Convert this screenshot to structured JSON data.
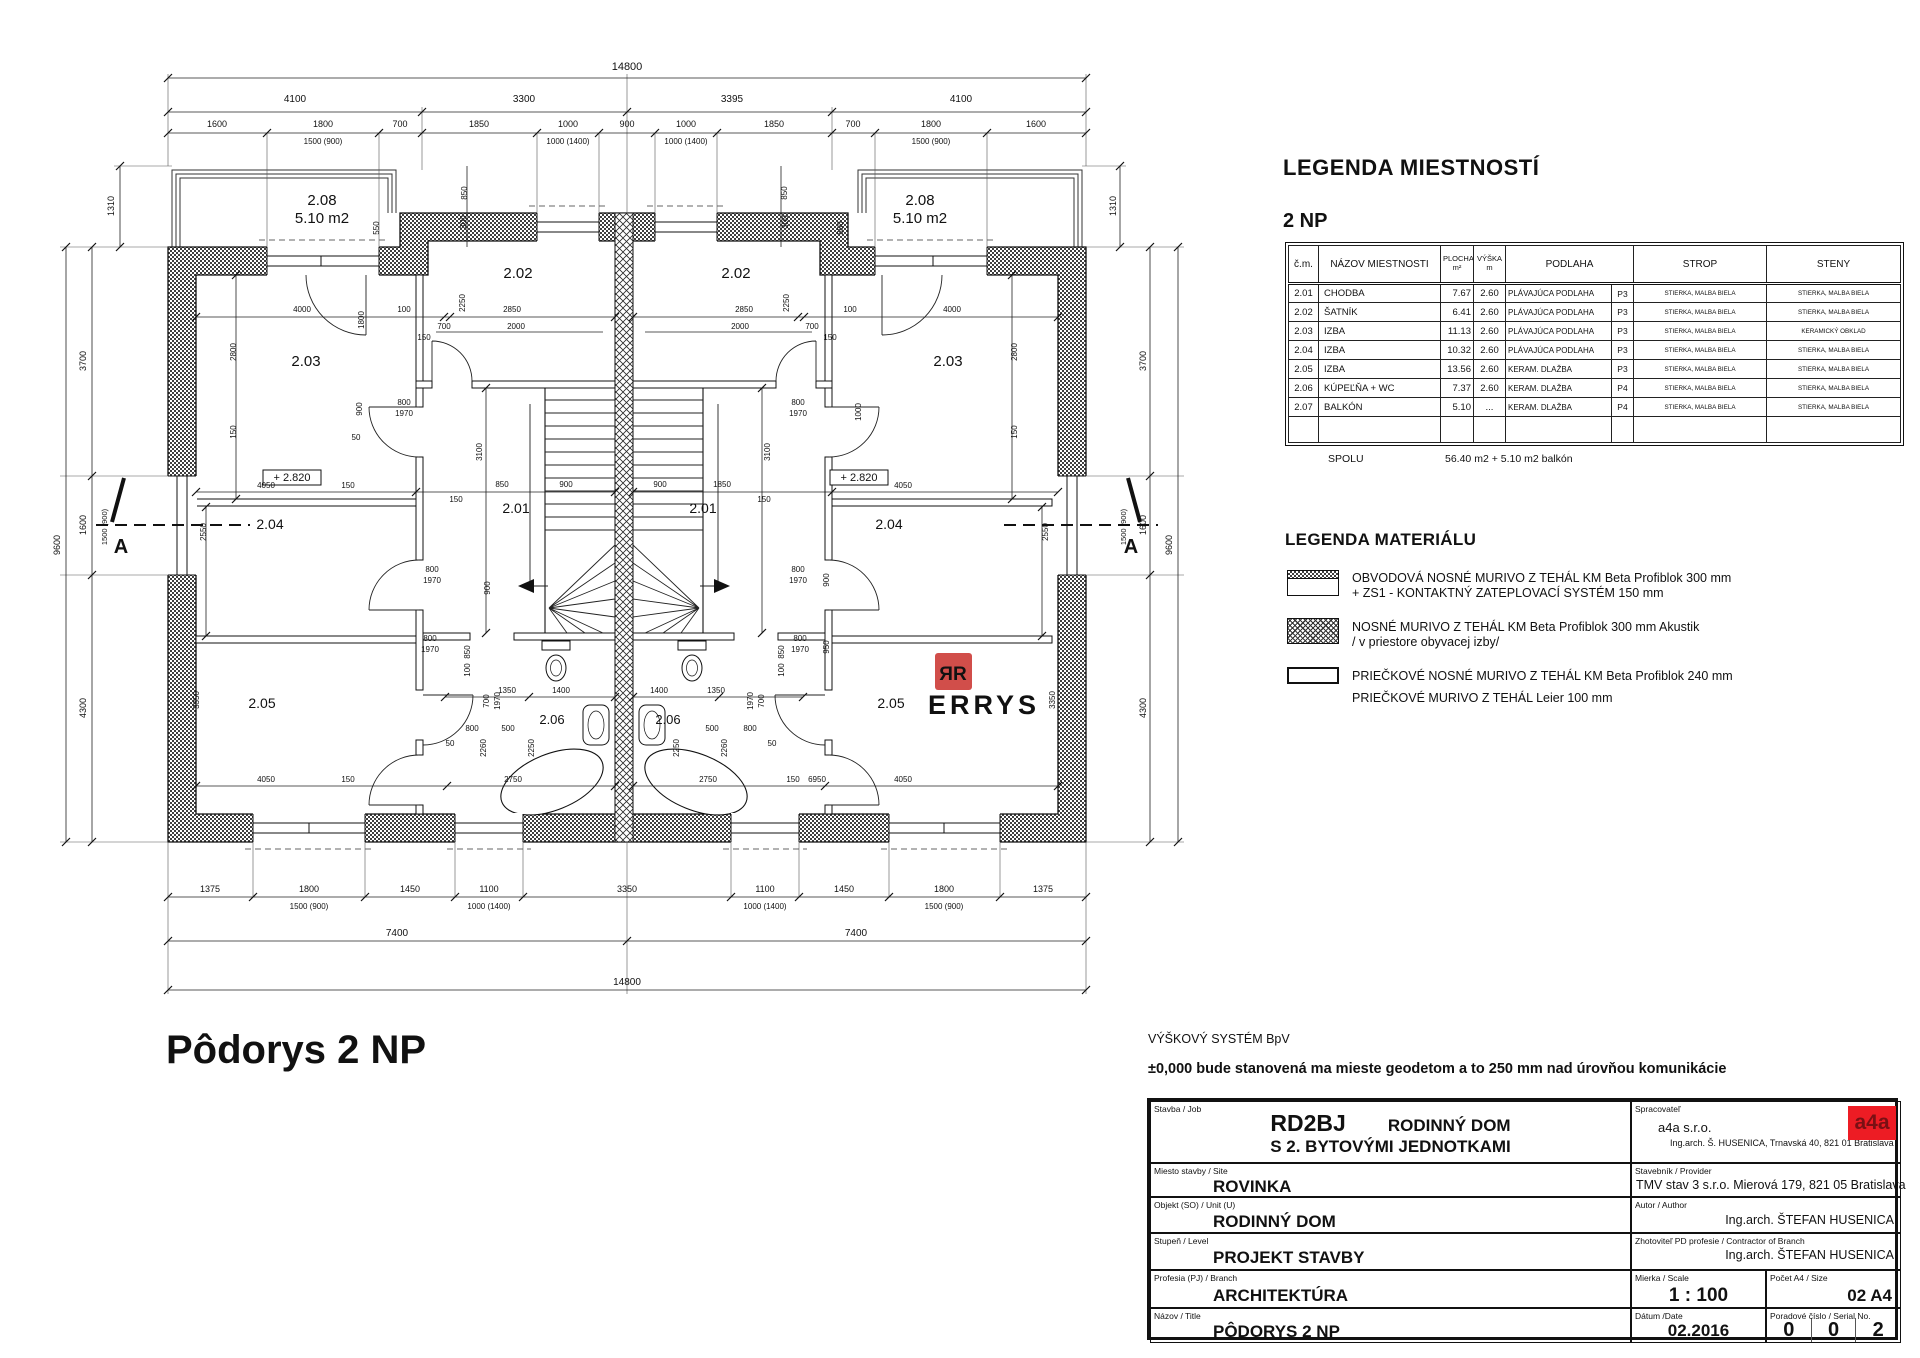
{
  "legend_rooms": {
    "title": "LEGENDA MIESTNOSTÍ",
    "subtitle": "2 NP",
    "header": {
      "cm": "č.m.",
      "nazov": "NÁZOV MIESTNOSTI",
      "plocha1": "PLOCHA",
      "plocha2": "m²",
      "vyska1": "VÝŠKA",
      "vyska2": "m",
      "podlaha": "PODLAHA",
      "strop": "STROP",
      "steny": "STENY"
    },
    "rows": [
      [
        "2.01",
        "CHODBA",
        "7.67",
        "2.60",
        "PLÁVAJÚCA PODLAHA",
        "P3",
        "STIERKA, MALBA BIELA",
        "STIERKA, MALBA BIELA"
      ],
      [
        "2.02",
        "ŠATNÍK",
        "6.41",
        "2.60",
        "PLÁVAJÚCA PODLAHA",
        "P3",
        "STIERKA, MALBA BIELA",
        "STIERKA, MALBA BIELA"
      ],
      [
        "2.03",
        "IZBA",
        "11.13",
        "2.60",
        "PLÁVAJÚCA PODLAHA",
        "P3",
        "STIERKA, MALBA BIELA",
        "KERAMICKÝ OBKLAD"
      ],
      [
        "2.04",
        "IZBA",
        "10.32",
        "2.60",
        "PLÁVAJÚCA PODLAHA",
        "P3",
        "STIERKA, MALBA BIELA",
        "STIERKA, MALBA BIELA"
      ],
      [
        "2.05",
        "IZBA",
        "13.56",
        "2.60",
        "KERAM. DLAŽBA",
        "P3",
        "STIERKA, MALBA BIELA",
        "STIERKA, MALBA BIELA"
      ],
      [
        "2.06",
        "KÚPEĽŇA + WC",
        "7.37",
        "2.60",
        "KERAM. DLAŽBA",
        "P4",
        "STIERKA, MALBA BIELA",
        "STIERKA, MALBA BIELA"
      ],
      [
        "2.07",
        "BALKÓN",
        "5.10",
        "...",
        "KERAM. DLAŽBA",
        "P4",
        "STIERKA, MALBA BIELA",
        "STIERKA, MALBA BIELA"
      ],
      [
        "",
        "",
        "",
        "",
        "",
        "",
        "",
        ""
      ]
    ],
    "spolu_label": "SPOLU",
    "spolu_value": "56.40 m2 + 5.10 m2 balkón"
  },
  "legend_material": {
    "title": "LEGENDA MATERIÁLU",
    "items": [
      {
        "line1": "OBVODOVÁ NOSNÉ MURIVO Z TEHÁL KM Beta Profiblok 300 mm",
        "line2": "+ ZS1 - KONTAKTNÝ ZATEPLOVACÍ SYSTÉM  150 mm"
      },
      {
        "line1": "NOSNÉ MURIVO Z TEHÁL KM Beta Profiblok 300 mm Akustik",
        "line2": "/ v priestore obyvacej izby/"
      },
      {
        "line1": "PRIEČKOVÉ NOSNÉ MURIVO Z TEHÁL KM Beta Profiblok 240 mm",
        "line2": "PRIEČKOVÉ MURIVO Z TEHÁL Leier 100 mm"
      }
    ]
  },
  "notes": {
    "line1": "VÝŠKOVÝ SYSTÉM BpV",
    "line2": "±0,000  bude stanovená ma mieste geodetom a to 250 mm nad úrovňou komunikácie"
  },
  "plan_title": "Pôdorys 2 NP",
  "colors": {
    "logo_red": "#ed1c24",
    "logo_text": "#7a1014",
    "watermark_red": "#cc3b36",
    "watermark_gray": "#c9c9c9"
  },
  "title_block": {
    "stavba_label": "Stavba / Job",
    "stavba_code": "RD2BJ",
    "stavba_value1": "RODINNÝ DOM",
    "stavba_value2": "S 2. BYTOVÝMI JEDNOTKAMI",
    "miesto_label": "Miesto stavby / Site",
    "miesto_value": "ROVINKA",
    "objekt_label": "Objekt (SO) / Unit (U)",
    "objekt_value": "RODINNÝ DOM",
    "stupen_label": "Stupeň / Level",
    "stupen_value": "PROJEKT STAVBY",
    "profesia_label": "Profesia (PJ) / Branch",
    "profesia_value": "ARCHITEKTÚRA",
    "nazov_label": "Názov / Title",
    "nazov_value": "PÔDORYS 2 NP",
    "spracovatel_label": "Spracovateľ",
    "spracovatel_value1": "a4a s.r.o.",
    "spracovatel_value2": "Ing.arch. Š. HUSENICA, Trnavská 40, 821 01 Bratislava",
    "logo": "a4a",
    "stavebnik_label": "Stavebník / Provider",
    "stavebnik_value": "TMV stav 3 s.r.o. Mierová 179, 821 05 Bratislava",
    "autor_label": "Autor / Author",
    "autor_value": "Ing.arch. ŠTEFAN HUSENICA",
    "zhotovitel_label": "Zhotoviteľ PD profesie / Contractor of Branch",
    "zhotovitel_value": "Ing.arch. ŠTEFAN HUSENICA",
    "mierka_label": "Mierka / Scale",
    "mierka_value": "1 : 100",
    "pocet_label": "Počet A4 / Size",
    "pocet_value": "02 A4",
    "datum_label": "Dátum /Date",
    "datum_value": "02.2016",
    "poradove_label": "Poradové číslo / Serial No.",
    "serial": [
      "0",
      "0",
      "2"
    ]
  },
  "plan": {
    "labels": [
      {
        "t": "14800",
        "x": 627,
        "y": 70,
        "s": 11
      },
      {
        "t": "4100",
        "x": 295,
        "y": 102,
        "s": 10
      },
      {
        "t": "3300",
        "x": 524,
        "y": 102,
        "s": 10
      },
      {
        "t": "3395",
        "x": 732,
        "y": 102,
        "s": 10
      },
      {
        "t": "4100",
        "x": 961,
        "y": 102,
        "s": 10
      },
      {
        "t": "1600",
        "x": 217,
        "y": 127,
        "s": 9
      },
      {
        "t": "1800",
        "x": 323,
        "y": 127,
        "s": 9
      },
      {
        "t": "700",
        "x": 400,
        "y": 127,
        "s": 9
      },
      {
        "t": "1850",
        "x": 479,
        "y": 127,
        "s": 9
      },
      {
        "t": "1000",
        "x": 568,
        "y": 127,
        "s": 9
      },
      {
        "t": "900",
        "x": 627,
        "y": 127,
        "s": 9
      },
      {
        "t": "1000",
        "x": 686,
        "y": 127,
        "s": 9
      },
      {
        "t": "1850",
        "x": 774,
        "y": 127,
        "s": 9
      },
      {
        "t": "700",
        "x": 853,
        "y": 127,
        "s": 9
      },
      {
        "t": "1800",
        "x": 931,
        "y": 127,
        "s": 9
      },
      {
        "t": "1600",
        "x": 1036,
        "y": 127,
        "s": 9
      },
      {
        "t": "1500 (900)",
        "x": 323,
        "y": 144,
        "s": 8
      },
      {
        "t": "1000 (1400)",
        "x": 568,
        "y": 144,
        "s": 8
      },
      {
        "t": "1000 (1400)",
        "x": 686,
        "y": 144,
        "s": 8
      },
      {
        "t": "1500 (900)",
        "x": 931,
        "y": 144,
        "s": 8
      },
      {
        "t": "1375",
        "x": 210,
        "y": 892,
        "s": 9
      },
      {
        "t": "1800",
        "x": 309,
        "y": 892,
        "s": 9
      },
      {
        "t": "1450",
        "x": 410,
        "y": 892,
        "s": 9
      },
      {
        "t": "1100",
        "x": 489,
        "y": 892,
        "s": 9
      },
      {
        "t": "3350",
        "x": 627,
        "y": 892,
        "s": 9
      },
      {
        "t": "1100",
        "x": 765,
        "y": 892,
        "s": 9
      },
      {
        "t": "1450",
        "x": 844,
        "y": 892,
        "s": 9
      },
      {
        "t": "1800",
        "x": 944,
        "y": 892,
        "s": 9
      },
      {
        "t": "1375",
        "x": 1043,
        "y": 892,
        "s": 9
      },
      {
        "t": "1500 (900)",
        "x": 309,
        "y": 909,
        "s": 8
      },
      {
        "t": "1000 (1400)",
        "x": 489,
        "y": 909,
        "s": 8
      },
      {
        "t": "1000 (1400)",
        "x": 765,
        "y": 909,
        "s": 8
      },
      {
        "t": "1500 (900)",
        "x": 944,
        "y": 909,
        "s": 8
      },
      {
        "t": "7400",
        "x": 397,
        "y": 936,
        "s": 10
      },
      {
        "t": "7400",
        "x": 856,
        "y": 936,
        "s": 10
      },
      {
        "t": "14800",
        "x": 627,
        "y": 985,
        "s": 10
      },
      {
        "t": "9600",
        "x": 60,
        "y": 545,
        "r": -90
      },
      {
        "t": "3700",
        "x": 86,
        "y": 361,
        "r": -90
      },
      {
        "t": "1600",
        "x": 86,
        "y": 525,
        "r": -90
      },
      {
        "t": "4300",
        "x": 86,
        "y": 708,
        "r": -90
      },
      {
        "t": "1500 (900)",
        "x": 107,
        "y": 527,
        "r": -90,
        "s": 7.5
      },
      {
        "t": "1310",
        "x": 114,
        "y": 206,
        "r": -90
      },
      {
        "t": "1310",
        "x": 1116,
        "y": 206,
        "r": -90
      },
      {
        "t": "3700",
        "x": 1146,
        "y": 361,
        "r": -90
      },
      {
        "t": "1600",
        "x": 1146,
        "y": 525,
        "r": -90
      },
      {
        "t": "4300",
        "x": 1146,
        "y": 708,
        "r": -90
      },
      {
        "t": "1500 (900)",
        "x": 1126,
        "y": 527,
        "r": -90,
        "s": 7.5
      },
      {
        "t": "9600",
        "x": 1172,
        "y": 545,
        "r": -90
      },
      {
        "t": "2.08",
        "x": 322,
        "y": 205,
        "s": 15
      },
      {
        "t": "5.10 m2",
        "x": 322,
        "y": 223,
        "s": 15
      },
      {
        "t": "2.08",
        "x": 920,
        "y": 205,
        "s": 15
      },
      {
        "t": "5.10 m2",
        "x": 920,
        "y": 223,
        "s": 15
      },
      {
        "t": "2.02",
        "x": 518,
        "y": 278,
        "s": 15
      },
      {
        "t": "2.02",
        "x": 736,
        "y": 278,
        "s": 15
      },
      {
        "t": "2.03",
        "x": 306,
        "y": 366,
        "s": 15
      },
      {
        "t": "2.03",
        "x": 948,
        "y": 366,
        "s": 15
      },
      {
        "t": "2.01",
        "x": 516,
        "y": 513,
        "s": 14
      },
      {
        "t": "2.01",
        "x": 703,
        "y": 513,
        "s": 14
      },
      {
        "t": "2.04",
        "x": 270,
        "y": 529,
        "s": 14
      },
      {
        "t": "2.04",
        "x": 889,
        "y": 529,
        "s": 14
      },
      {
        "t": "2.05",
        "x": 262,
        "y": 708,
        "s": 14
      },
      {
        "t": "2.05",
        "x": 891,
        "y": 708,
        "s": 14
      },
      {
        "t": "2.06",
        "x": 552,
        "y": 724,
        "s": 13
      },
      {
        "t": "2.06",
        "x": 668,
        "y": 724,
        "s": 13
      },
      {
        "t": "+ 2.820",
        "x": 292,
        "y": 481,
        "s": 11
      },
      {
        "t": "+ 2.820",
        "x": 859,
        "y": 481,
        "s": 11
      },
      {
        "t": "A",
        "x": 121,
        "y": 553,
        "s": 20,
        "w": 700
      },
      {
        "t": "A",
        "x": 1131,
        "y": 553,
        "s": 20,
        "w": 700
      },
      {
        "t": "4000",
        "x": 302,
        "y": 312,
        "s": 8
      },
      {
        "t": "100",
        "x": 404,
        "y": 312,
        "s": 8
      },
      {
        "t": "2850",
        "x": 512,
        "y": 312,
        "s": 8
      },
      {
        "t": "150",
        "x": 424,
        "y": 340,
        "s": 8
      },
      {
        "t": "700",
        "x": 444,
        "y": 329,
        "s": 8
      },
      {
        "t": "2000",
        "x": 516,
        "y": 329,
        "s": 8
      },
      {
        "t": "2800",
        "x": 236,
        "y": 352,
        "r": -90,
        "s": 8
      },
      {
        "t": "150",
        "x": 236,
        "y": 432,
        "r": -90,
        "s": 8
      },
      {
        "t": "1800",
        "x": 364,
        "y": 320,
        "r": -90,
        "s": 8
      },
      {
        "t": "2250",
        "x": 465,
        "y": 303,
        "r": -90,
        "s": 8
      },
      {
        "t": "850",
        "x": 467,
        "y": 193,
        "r": -90,
        "s": 8
      },
      {
        "t": "300",
        "x": 466,
        "y": 222,
        "r": -90,
        "s": 8
      },
      {
        "t": "550",
        "x": 379,
        "y": 228,
        "r": -90,
        "s": 8
      },
      {
        "t": "900",
        "x": 362,
        "y": 409,
        "r": -90,
        "s": 8
      },
      {
        "t": "50",
        "x": 356,
        "y": 440,
        "s": 8
      },
      {
        "t": "800",
        "x": 404,
        "y": 405,
        "s": 8
      },
      {
        "t": "1970",
        "x": 404,
        "y": 416,
        "s": 8
      },
      {
        "t": "2550",
        "x": 206,
        "y": 532,
        "r": -90,
        "s": 8
      },
      {
        "t": "4050",
        "x": 266,
        "y": 488,
        "s": 8
      },
      {
        "t": "150",
        "x": 348,
        "y": 488,
        "s": 8
      },
      {
        "t": "3100",
        "x": 482,
        "y": 452,
        "r": -90,
        "s": 8
      },
      {
        "t": "850",
        "x": 502,
        "y": 487,
        "s": 8
      },
      {
        "t": "900",
        "x": 566,
        "y": 487,
        "s": 8
      },
      {
        "t": "150",
        "x": 456,
        "y": 502,
        "s": 8
      },
      {
        "t": "900",
        "x": 490,
        "y": 588,
        "r": -90,
        "s": 8
      },
      {
        "t": "850",
        "x": 470,
        "y": 652,
        "r": -90,
        "s": 8
      },
      {
        "t": "100",
        "x": 470,
        "y": 670,
        "r": -90,
        "s": 8
      },
      {
        "t": "800",
        "x": 432,
        "y": 572,
        "s": 8
      },
      {
        "t": "1970",
        "x": 432,
        "y": 583,
        "s": 8
      },
      {
        "t": "800",
        "x": 430,
        "y": 641,
        "s": 8
      },
      {
        "t": "1970",
        "x": 430,
        "y": 652,
        "s": 8
      },
      {
        "t": "700",
        "x": 489,
        "y": 701,
        "r": -90,
        "s": 8
      },
      {
        "t": "1970",
        "x": 500,
        "y": 701,
        "r": -90,
        "s": 8
      },
      {
        "t": "1350",
        "x": 507,
        "y": 693,
        "s": 8
      },
      {
        "t": "1400",
        "x": 561,
        "y": 693,
        "s": 8
      },
      {
        "t": "800",
        "x": 472,
        "y": 731,
        "s": 8
      },
      {
        "t": "500",
        "x": 508,
        "y": 731,
        "s": 8
      },
      {
        "t": "50",
        "x": 450,
        "y": 746,
        "s": 8
      },
      {
        "t": "2260",
        "x": 486,
        "y": 748,
        "r": -90,
        "s": 8
      },
      {
        "t": "2250",
        "x": 534,
        "y": 748,
        "r": -90,
        "s": 8
      },
      {
        "t": "2750",
        "x": 513,
        "y": 782,
        "s": 8
      },
      {
        "t": "3350",
        "x": 199,
        "y": 700,
        "r": -90,
        "s": 8
      },
      {
        "t": "150",
        "x": 348,
        "y": 782,
        "s": 8
      },
      {
        "t": "4050",
        "x": 266,
        "y": 782,
        "s": 8
      },
      {
        "t": "4000",
        "x": 952,
        "y": 312,
        "s": 8
      },
      {
        "t": "100",
        "x": 850,
        "y": 312,
        "s": 8
      },
      {
        "t": "2850",
        "x": 744,
        "y": 312,
        "s": 8
      },
      {
        "t": "150",
        "x": 830,
        "y": 340,
        "s": 8
      },
      {
        "t": "700",
        "x": 812,
        "y": 329,
        "s": 8
      },
      {
        "t": "2000",
        "x": 740,
        "y": 329,
        "s": 8
      },
      {
        "t": "2800",
        "x": 1017,
        "y": 352,
        "r": -90,
        "s": 8
      },
      {
        "t": "150",
        "x": 1017,
        "y": 432,
        "r": -90,
        "s": 8
      },
      {
        "t": "2250",
        "x": 789,
        "y": 303,
        "r": -90,
        "s": 8
      },
      {
        "t": "850",
        "x": 787,
        "y": 193,
        "r": -90,
        "s": 8
      },
      {
        "t": "300",
        "x": 788,
        "y": 222,
        "r": -90,
        "s": 8
      },
      {
        "t": "550",
        "x": 843,
        "y": 228,
        "r": -90,
        "s": 8
      },
      {
        "t": "1000",
        "x": 861,
        "y": 412,
        "r": -90,
        "s": 8
      },
      {
        "t": "800",
        "x": 798,
        "y": 405,
        "s": 8
      },
      {
        "t": "1970",
        "x": 798,
        "y": 416,
        "s": 8
      },
      {
        "t": "2550",
        "x": 1048,
        "y": 532,
        "r": -90,
        "s": 8
      },
      {
        "t": "4050",
        "x": 903,
        "y": 488,
        "s": 8
      },
      {
        "t": "3100",
        "x": 770,
        "y": 452,
        "r": -90,
        "s": 8
      },
      {
        "t": "900",
        "x": 660,
        "y": 487,
        "s": 8
      },
      {
        "t": "1850",
        "x": 722,
        "y": 487,
        "s": 8
      },
      {
        "t": "150",
        "x": 764,
        "y": 502,
        "s": 8
      },
      {
        "t": "900",
        "x": 829,
        "y": 580,
        "r": -90,
        "s": 8
      },
      {
        "t": "950",
        "x": 829,
        "y": 647,
        "r": -90,
        "s": 8
      },
      {
        "t": "850",
        "x": 784,
        "y": 652,
        "r": -90,
        "s": 8
      },
      {
        "t": "100",
        "x": 784,
        "y": 670,
        "r": -90,
        "s": 8
      },
      {
        "t": "800",
        "x": 798,
        "y": 572,
        "s": 8
      },
      {
        "t": "1970",
        "x": 798,
        "y": 583,
        "s": 8
      },
      {
        "t": "800",
        "x": 800,
        "y": 641,
        "s": 8
      },
      {
        "t": "1970",
        "x": 800,
        "y": 652,
        "s": 8
      },
      {
        "t": "1970",
        "x": 753,
        "y": 701,
        "r": -90,
        "s": 8
      },
      {
        "t": "700",
        "x": 764,
        "y": 701,
        "r": -90,
        "s": 8
      },
      {
        "t": "1350",
        "x": 716,
        "y": 693,
        "s": 8
      },
      {
        "t": "1400",
        "x": 659,
        "y": 693,
        "s": 8
      },
      {
        "t": "800",
        "x": 750,
        "y": 731,
        "s": 8
      },
      {
        "t": "500",
        "x": 712,
        "y": 731,
        "s": 8
      },
      {
        "t": "50",
        "x": 772,
        "y": 746,
        "s": 8
      },
      {
        "t": "2260",
        "x": 727,
        "y": 748,
        "r": -90,
        "s": 8
      },
      {
        "t": "2250",
        "x": 679,
        "y": 748,
        "r": -90,
        "s": 8
      },
      {
        "t": "2750",
        "x": 708,
        "y": 782,
        "s": 8
      },
      {
        "t": "3350",
        "x": 1055,
        "y": 700,
        "r": -90,
        "s": 8
      },
      {
        "t": "150",
        "x": 793,
        "y": 782,
        "s": 8
      },
      {
        "t": "6950",
        "x": 817,
        "y": 782,
        "s": 8
      },
      {
        "t": "4050",
        "x": 903,
        "y": 782,
        "s": 8
      },
      {
        "t": "ЯR",
        "x": 953,
        "y": 680,
        "s": 19,
        "w": 700,
        "c": "#ffffff",
        "n": "watermark-logo-text"
      },
      {
        "t": "ERRYS",
        "x": 984,
        "y": 714,
        "s": 27,
        "w": 700,
        "c": "#c9c9c9",
        "ls": 4,
        "n": "watermark-text"
      }
    ]
  }
}
